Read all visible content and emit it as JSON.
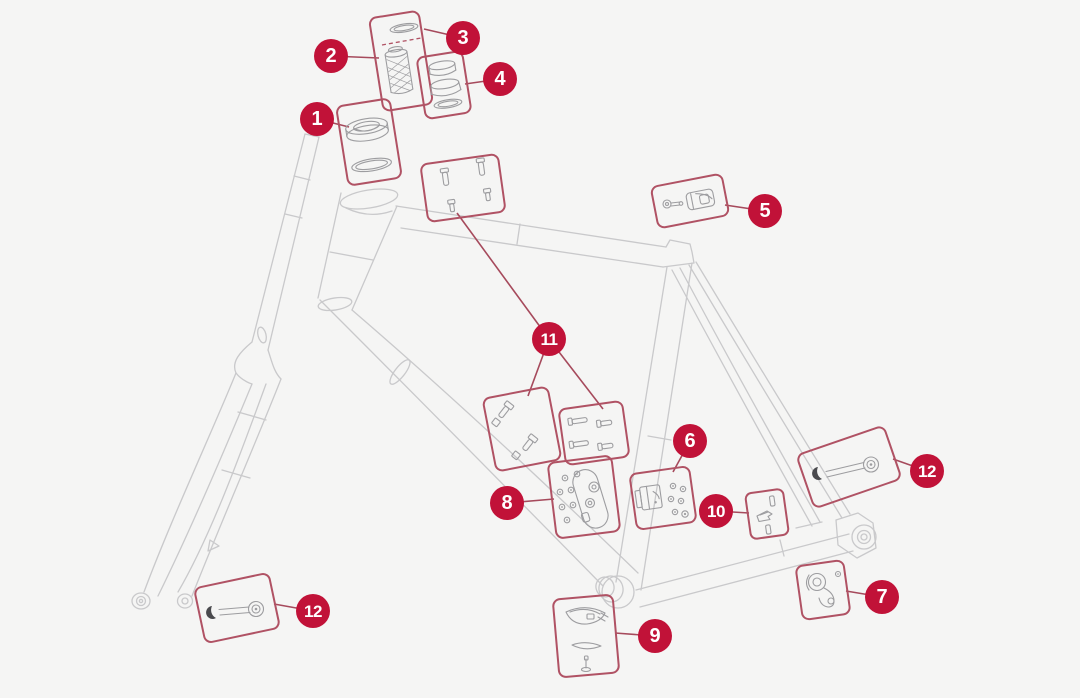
{
  "colors": {
    "background": "#f5f5f4",
    "badge": "#c11238",
    "badge_text": "#ffffff",
    "box_border": "#b05264",
    "leader_line": "#a64a5c",
    "frame_line": "#c9c9cb",
    "part_line": "#9d9da0",
    "part_dark": "#4a4a4e"
  },
  "callouts": [
    {
      "label": "1",
      "icon": "headset-bearings"
    },
    {
      "label": "2",
      "icon": "expander-plug"
    },
    {
      "label": "3",
      "icon": "top-cap-seal"
    },
    {
      "label": "4",
      "icon": "headset-spacers"
    },
    {
      "label": "5",
      "icon": "bolt-and-clamp"
    },
    {
      "label": "6",
      "icon": "bracket-and-screws"
    },
    {
      "label": "7",
      "icon": "derailleur-hanger"
    },
    {
      "label": "8",
      "icon": "cover-plate-and-screws"
    },
    {
      "label": "9",
      "icon": "frame-protector-and-bolt"
    },
    {
      "label": "10",
      "icon": "pins-and-clip"
    },
    {
      "label": "11",
      "icon": "mounting-bolts"
    },
    {
      "label": "12",
      "icon": "thru-axle"
    }
  ]
}
